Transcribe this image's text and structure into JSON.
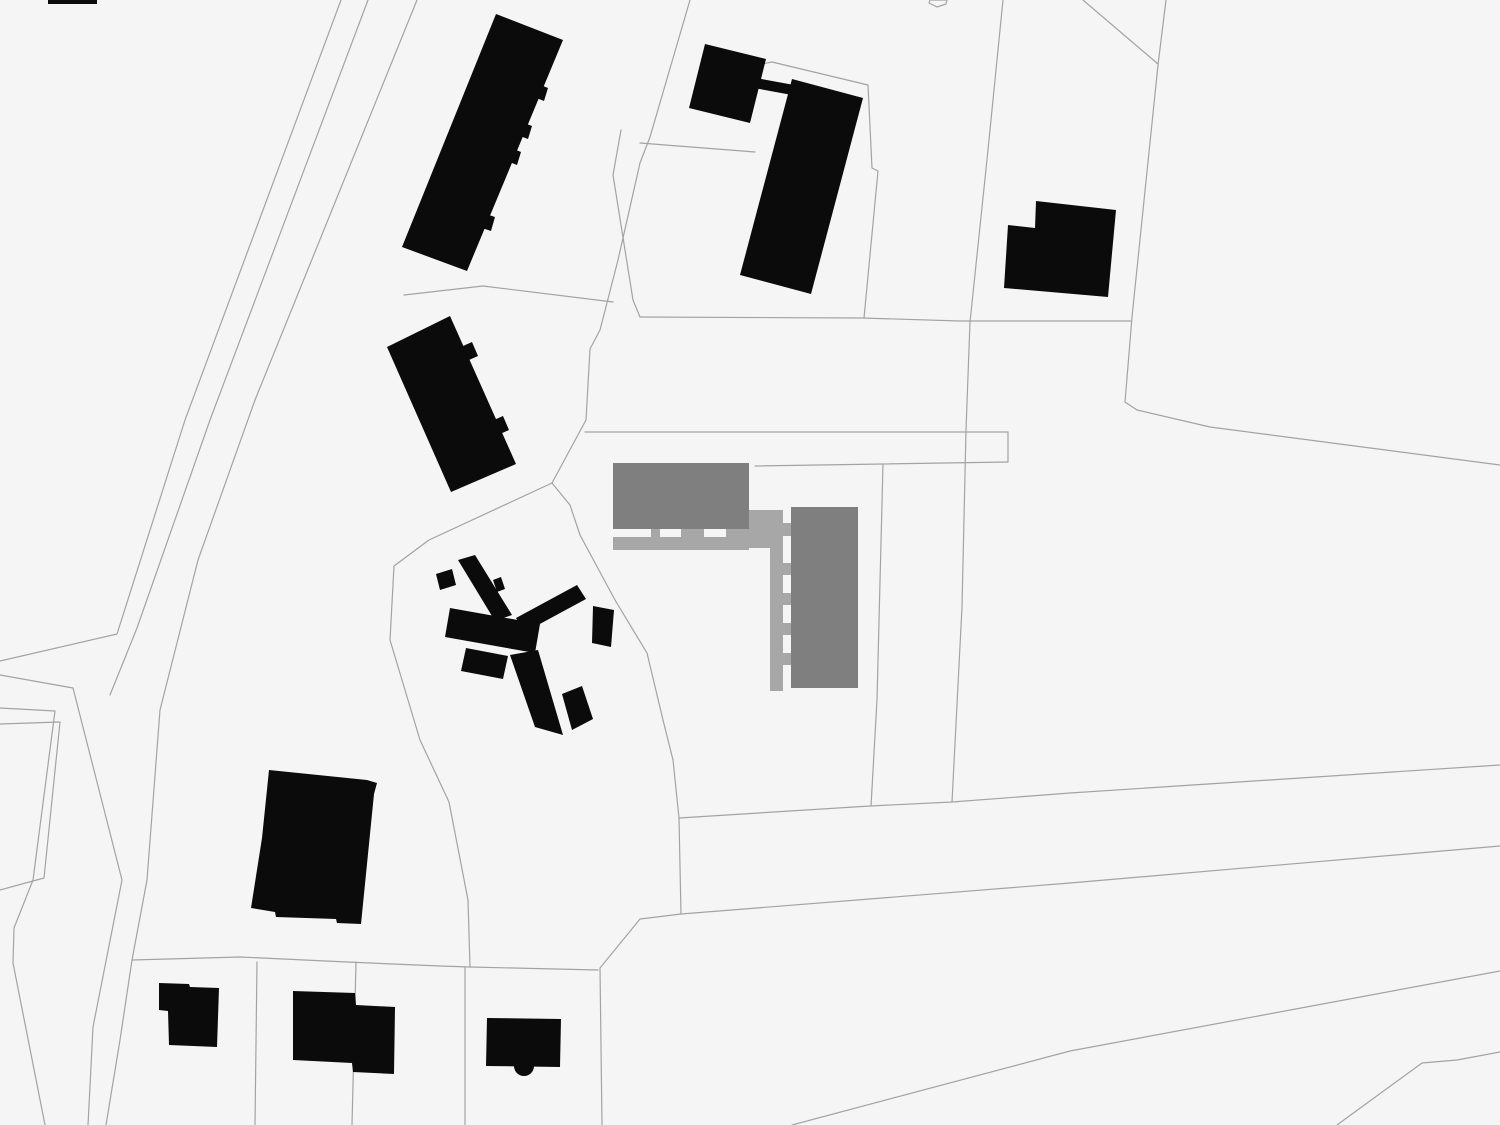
{
  "map": {
    "width": 1500,
    "height": 1125,
    "colors": {
      "background": "#f5f5f5",
      "parcel_line": "#a3a3a3",
      "building_black": "#0b0b0b",
      "project_dark_gray": "#7f7f7f",
      "project_light_gray": "#a7a7a7"
    },
    "parcel_lines": [
      {
        "name": "road-west-edge-1",
        "points": "341,0 185,420 117,634 0,661"
      },
      {
        "name": "road-west-edge-2",
        "points": "368,0 210,420 137,628 110,695"
      },
      {
        "name": "road-branch-lower-edge",
        "points": "0,675 73,688 122,880 93,1027 88,1125"
      },
      {
        "name": "road-east-edge",
        "points": "417,0 255,400 198,560 160,710 147,880 132,960 120,1040 106,1125"
      },
      {
        "name": "bottom-row-north-boundary",
        "points": "132,960 240,957 347,962 440,966 470,967 598,970"
      },
      {
        "name": "left-band-outer",
        "points": "0,708 55,711 33,880 14,928 13,963 45,1125"
      },
      {
        "name": "left-band-inner",
        "points": "0,724 60,722 44,878 0,890"
      },
      {
        "name": "lot-divider-vertical-1",
        "points": "257,962 255,1125"
      },
      {
        "name": "lot-divider-vertical-2",
        "points": "356,962 352,1125"
      },
      {
        "name": "lot-divider-vertical-3",
        "points": "465,967 465,1125"
      },
      {
        "name": "lot-divider-vertical-4",
        "points": "681,914 640,919 600,968 602,1125"
      },
      {
        "name": "project-west-boundary",
        "points": "552,483 570,505 580,535 615,600 647,653 663,720 673,760 679,818 681,914"
      },
      {
        "name": "southwest-lot-boundary",
        "points": "552,483 429,540 394,566 390,640 420,740 449,802 468,900 470,967"
      },
      {
        "name": "north-lots-west-boundary",
        "points": "690,0 650,137 640,163 618,260 600,330 590,349 586,420 552,483"
      },
      {
        "name": "north-lot-divider",
        "points": "621,130 613,175 633,300 640,317"
      },
      {
        "name": "mid-horizontal-boundary",
        "points": "640,317 862,318 960,321 1131,321"
      },
      {
        "name": "north-building-lot-south",
        "points": "404,295 483,286 613,302"
      },
      {
        "name": "north-lots-divider-2",
        "points": "640,143 755,152"
      },
      {
        "name": "slab-lot-outline",
        "points": "700,76 772,62 868,85 872,168 878,171 864,318"
      },
      {
        "name": "footpath-top",
        "points": "585,432 1008,432"
      },
      {
        "name": "footpath-bottom",
        "points": "755,466 883,464 1008,462"
      },
      {
        "name": "footpath-end-cap",
        "points": "1008,432 1008,462"
      },
      {
        "name": "footpath-corner-vertical",
        "points": "883,464 877,700 871,806"
      },
      {
        "name": "east-horizontal-boundary-1",
        "points": "679,818 870,806 952,802 1070,793 1500,765"
      },
      {
        "name": "east-horizontal-boundary-2",
        "points": "681,914 1070,883 1500,846"
      },
      {
        "name": "northeast-lot-boundary",
        "points": "1003,0 988,150 970,322 966,430 962,607 952,802"
      },
      {
        "name": "topright-lot-west-boundary",
        "points": "1166,0 1158,65 1132,317 1125,402 1137,410 1210,427 1500,465"
      },
      {
        "name": "topright-diagonal",
        "points": "1083,0 1158,64"
      },
      {
        "name": "bottomright-road-upper-edge",
        "points": "792,1125 1070,1051 1500,971"
      },
      {
        "name": "bottomright-road-lower-edge",
        "points": "1337,1125 1422,1063 1457,1060 1500,1052"
      },
      {
        "name": "tiny-parcel-outline",
        "points": "930,0 947,0 946,4 937,7 929,3 930,0"
      }
    ],
    "black_buildings": [
      {
        "name": "building-north-slab",
        "points": "496,14 563,40 467,271 402,247"
      },
      {
        "name": "building-north-slab-tab-1",
        "points": "538,84 548,88 544,101 534,97"
      },
      {
        "name": "building-north-slab-tab-2",
        "points": "524,123 532,126 528,139 520,136"
      },
      {
        "name": "building-north-slab-tab-3",
        "points": "511,148 521,152 517,165 507,161"
      },
      {
        "name": "building-north-slab-tab-4",
        "points": "486,214 495,217 491,231 482,228"
      },
      {
        "name": "building-mid-slab",
        "points": "387,347 450,316 516,464 451,492"
      },
      {
        "name": "building-mid-slab-tab-1",
        "points": "463,346 472,342 478,356 469,360"
      },
      {
        "name": "building-mid-slab-tab-2",
        "points": "494,420 503,416 509,430 500,434"
      },
      {
        "name": "building-northeast-square",
        "points": "705,44 766,59 750,123 689,108"
      },
      {
        "name": "building-northeast-bridge",
        "points": "756,78 794,85 792,95 754,88"
      },
      {
        "name": "building-northeast-slab",
        "points": "792,79 863,98 811,294 740,275"
      },
      {
        "name": "building-far-northeast",
        "points": "1036,201 1116,210 1108,297 1004,288 1008,225 1035,228"
      },
      {
        "name": "building-cross-northwest-wing",
        "points": "458,560 475,555 512,615 495,621"
      },
      {
        "name": "building-cross-wing-bulge",
        "points": "493,580 501,577 505,589 497,592"
      },
      {
        "name": "building-cross-left-step",
        "points": "436,574 452,569 456,585 440,590"
      },
      {
        "name": "building-cross-central-bar",
        "points": "450,608 540,624 535,653 445,637"
      },
      {
        "name": "building-cross-lower-mass",
        "points": "466,648 508,656 503,679 461,671"
      },
      {
        "name": "building-cross-east-arm",
        "points": "516,618 577,585 586,599 525,632"
      },
      {
        "name": "building-cross-arm-block",
        "points": "593,606 614,610 611,647 592,643"
      },
      {
        "name": "building-cross-south-wing",
        "points": "510,655 538,650 563,735 535,727"
      },
      {
        "name": "building-cross-se-block",
        "points": "562,694 582,686 593,719 572,730"
      },
      {
        "name": "building-southwest-large",
        "points": "269,770 367,780 377,783 374,794 361,924 337,923 336,919 276,917 275,912 251,908 262,838"
      },
      {
        "name": "building-small-house-1",
        "points": "159,983 189,984 190,987 219,988 217,1047 169,1045 168,1011 159,1010"
      },
      {
        "name": "building-small-house-2",
        "points": "293,991 355,993 356,1005 395,1007 394,1074 353,1072 352,1063 293,1060"
      },
      {
        "name": "building-small-house-3",
        "points": "487,1018 561,1019 560,1067 486,1066"
      },
      {
        "name": "building-edge-fragment-top",
        "points": "48,0 97,0 97,4 48,4"
      }
    ],
    "black_circles": [
      {
        "name": "building-cross-apse",
        "cx": 483,
        "cy": 667,
        "r": 7.5
      },
      {
        "name": "building-small-house-3-apse",
        "cx": 524,
        "cy": 1066,
        "r": 10
      }
    ],
    "project_dark_buildings": [
      {
        "name": "project-building-north-wing",
        "points": "613,463 749,463 749,529 613,529"
      },
      {
        "name": "project-building-east-wing",
        "points": "791,507 858,507 858,688 791,688"
      }
    ],
    "project_light_elements": [
      {
        "name": "project-gallery-strip-horizontal",
        "points": "613,537 746,537 746,550 613,550"
      },
      {
        "name": "project-gallery-tab-a",
        "points": "651,529 660,529 660,537 651,537"
      },
      {
        "name": "project-gallery-tab-b",
        "points": "681,529 704,529 704,537 681,537"
      },
      {
        "name": "project-gallery-right-block",
        "points": "726,529 749,529 749,550 726,550"
      },
      {
        "name": "project-corner-square",
        "points": "749,510 783,510 783,548 749,548"
      },
      {
        "name": "project-gallery-strip-vertical",
        "points": "770,548 783,548 783,691 770,691"
      },
      {
        "name": "project-gallery-tab-1",
        "points": "783,523 791,523 791,536 783,536"
      },
      {
        "name": "project-gallery-tab-2",
        "points": "783,563 791,563 791,575 783,575"
      },
      {
        "name": "project-gallery-tab-3",
        "points": "783,593 791,593 791,605 783,605"
      },
      {
        "name": "project-gallery-tab-4",
        "points": "783,623 791,623 791,635 783,635"
      },
      {
        "name": "project-gallery-tab-5",
        "points": "783,653 791,653 791,665 783,665"
      }
    ]
  }
}
